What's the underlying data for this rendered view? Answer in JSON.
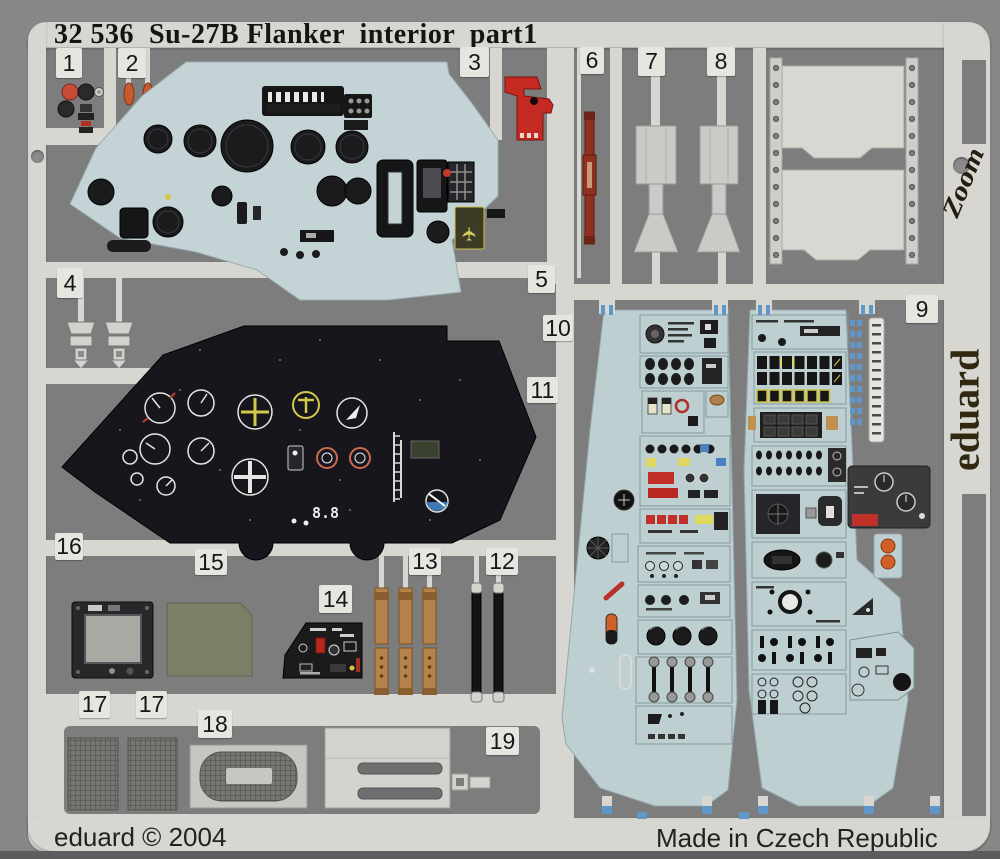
{
  "title": "32 536  Su-27B Flanker  interior  part1",
  "labels": [
    "1",
    "2",
    "3",
    "4",
    "5",
    "6",
    "7",
    "8",
    "9",
    "10",
    "11",
    "12",
    "13",
    "14",
    "15",
    "16",
    "17",
    "17",
    "18",
    "19"
  ],
  "footer": {
    "copyright": "eduard © 2004",
    "origin": "Made in Czech Republic"
  },
  "branding": {
    "maker": "eduard",
    "series": "Zoom"
  },
  "panel_readout": "8.8",
  "colors": {
    "frame": "#d7d6d1",
    "field": "#7d7d7d",
    "panel_blue": "#c4d4d6",
    "console_blue": "#becfd2",
    "panel_dark": "#16161c",
    "accent_red": "#c52a22",
    "maroon": "#8f3020",
    "strap_tan": "#b5824a",
    "tab_blue": "#5f97c9",
    "olive_panel": "#7c7f68"
  }
}
